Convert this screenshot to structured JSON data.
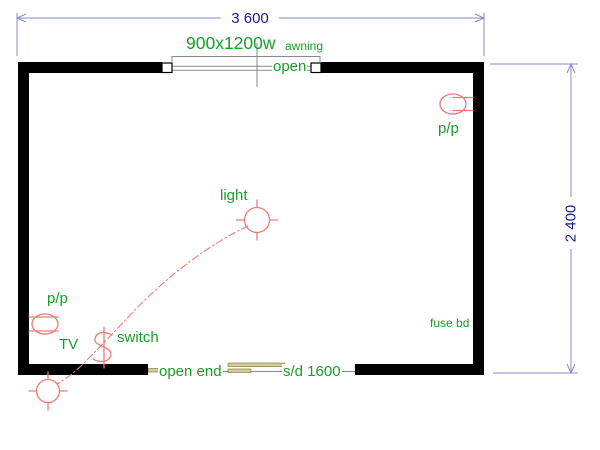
{
  "dimensions": {
    "width": "3 600",
    "height": "2 400"
  },
  "window": {
    "size": "900x1200w",
    "type": "awning",
    "state": "open"
  },
  "door": {
    "end": "open end",
    "spec": "s/d 1600"
  },
  "labels": {
    "light": "light",
    "switch": "switch",
    "pp_right": "p/p",
    "pp_left": "p/p",
    "tv": "TV",
    "fuse": "fuse bd"
  },
  "symbols": {
    "light": "ceiling-light-symbol",
    "outdoor_light": "crosshair-light-symbol",
    "switch": "switch-symbol",
    "power_point_left": "power-point-symbol",
    "power_point_right": "power-point-symbol",
    "window": "awning-window-symbol",
    "sliding_door": "sliding-door-symbol",
    "wiring": "switch-wiring-dashed-arc"
  },
  "colors": {
    "wall": "#000000",
    "label_green": "#16A024",
    "symbol_red": "#EE7A7A",
    "dimension_line": "#8A8ACD",
    "dimension_text": "#1B1B8A",
    "window_line": "#8A8A8A",
    "door_fill": "#D8CB8E",
    "door_edge": "#6E6E3A"
  }
}
